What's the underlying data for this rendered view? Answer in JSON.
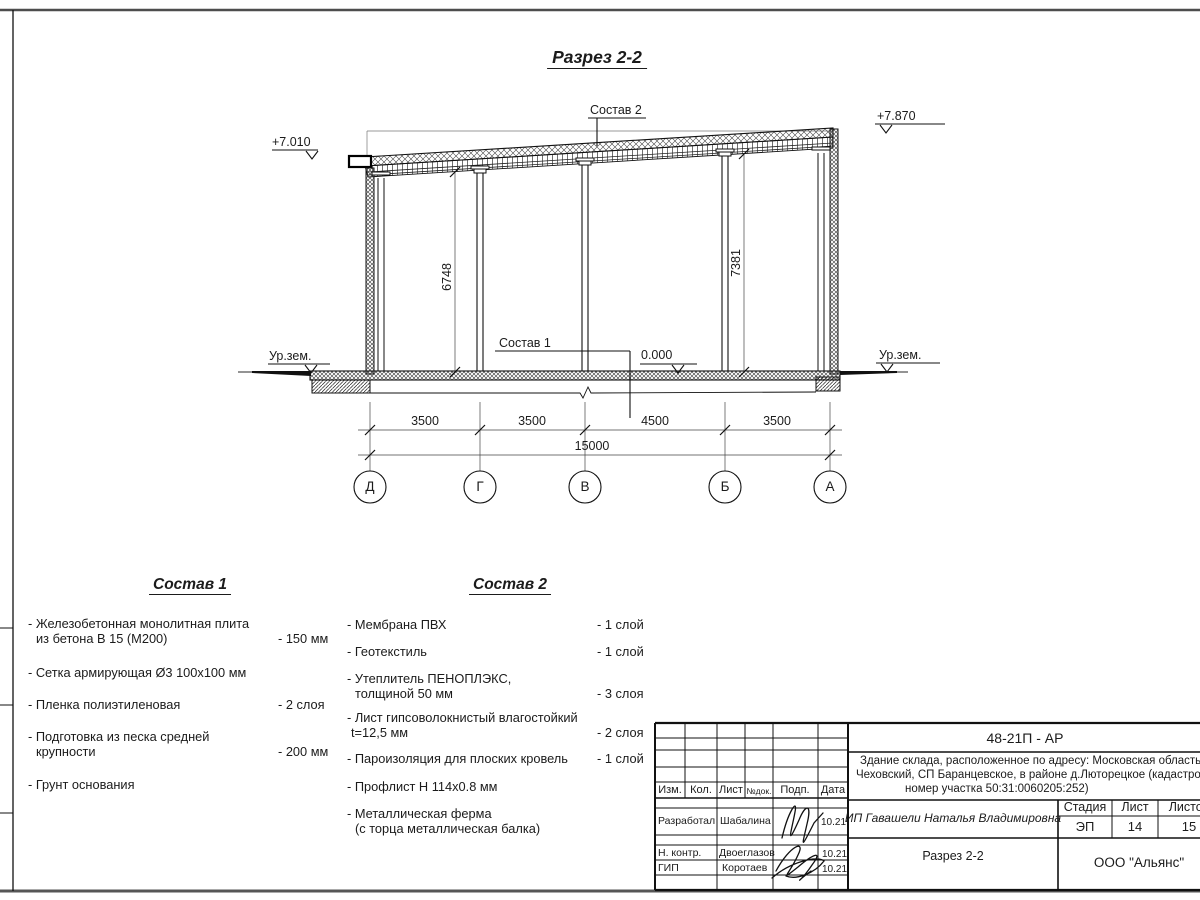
{
  "page": {
    "title": "Разрез 2-2"
  },
  "drawing": {
    "elev_left": "+7.010",
    "elev_right": "+7.870",
    "elev_zero": "0.000",
    "ground_left": "Ур.зем.",
    "ground_right": "Ур.зем.",
    "label_sostav2": "Состав 2",
    "label_sostav1": "Состав 1",
    "dim_left": "6748",
    "dim_right": "7381",
    "dims": [
      "3500",
      "3500",
      "4500",
      "3500"
    ],
    "dim_total": "15000",
    "axes": [
      "Д",
      "Г",
      "В",
      "Б",
      "А"
    ]
  },
  "sostav1": {
    "title": "Состав 1",
    "items": [
      {
        "l1": "- Железобетонная  монолитная плита",
        "l2": "из бетона В 15 (М200)",
        "value": "- 150 мм"
      },
      {
        "l1": "- Сетка армирующая Ø3 100x100 мм",
        "l2": "",
        "value": ""
      },
      {
        "l1": "- Пленка полиэтиленовая",
        "l2": "",
        "value": "-  2 слоя"
      },
      {
        "l1": "- Подготовка из песка средней",
        "l2": "крупности",
        "value": "- 200 мм"
      },
      {
        "l1": "- Грунт основания",
        "l2": "",
        "value": ""
      }
    ]
  },
  "sostav2": {
    "title": "Состав 2",
    "items": [
      {
        "l1": "- Мембрана ПВХ",
        "l2": "",
        "value": "- 1 слой"
      },
      {
        "l1": "- Геотекстиль",
        "l2": "",
        "value": "- 1 слой"
      },
      {
        "l1": "- Утеплитель ПЕНОПЛЭКС,",
        "l2": "толщиной 50 мм",
        "value": "- 3 слоя"
      },
      {
        "l1": "- Лист гипсоволокнистый влагостойкий",
        "l2": "t=12,5 мм",
        "value": "- 2 слоя"
      },
      {
        "l1": "- Пароизоляция для плоских кровель",
        "l2": "",
        "value": "- 1 слой"
      },
      {
        "l1": "- Профлист Н 114х0.8 мм",
        "l2": "",
        "value": ""
      },
      {
        "l1": "- Металлическая ферма",
        "l2": "(с торца металлическая балка)",
        "value": ""
      }
    ]
  },
  "titleblock": {
    "code": "48-21П - АР",
    "address1": "Здание склада, расположенное по адресу: Московская область, р",
    "address2": "Чеховский, СП Баранцевское, в районе д.Люторецкое  (кадастровы",
    "address3": "номер участка 50:31:0060205:252)",
    "col_izm": "Изм.",
    "col_kol": "Кол.",
    "col_list": "Лист",
    "col_ndok": "№док.",
    "col_podp": "Подп.",
    "col_data": "Дата",
    "rows": [
      {
        "role": "Разработал",
        "name": "Шабалина",
        "date": "10.21"
      },
      {
        "role": "Н. контр.",
        "name": "Двоеглазов",
        "date": "10.21"
      },
      {
        "role": "ГИП",
        "name": "Коротаев",
        "date": "10.21"
      }
    ],
    "client": "ИП Гавашели Наталья Владимировна",
    "stage_label": "Стадия",
    "sheet_label": "Лист",
    "sheets_label": "Листов",
    "stage": "ЭП",
    "sheet": "14",
    "sheets": "15",
    "doc_title": "Разрез 2-2",
    "company": "ООО \"Альянс\""
  }
}
